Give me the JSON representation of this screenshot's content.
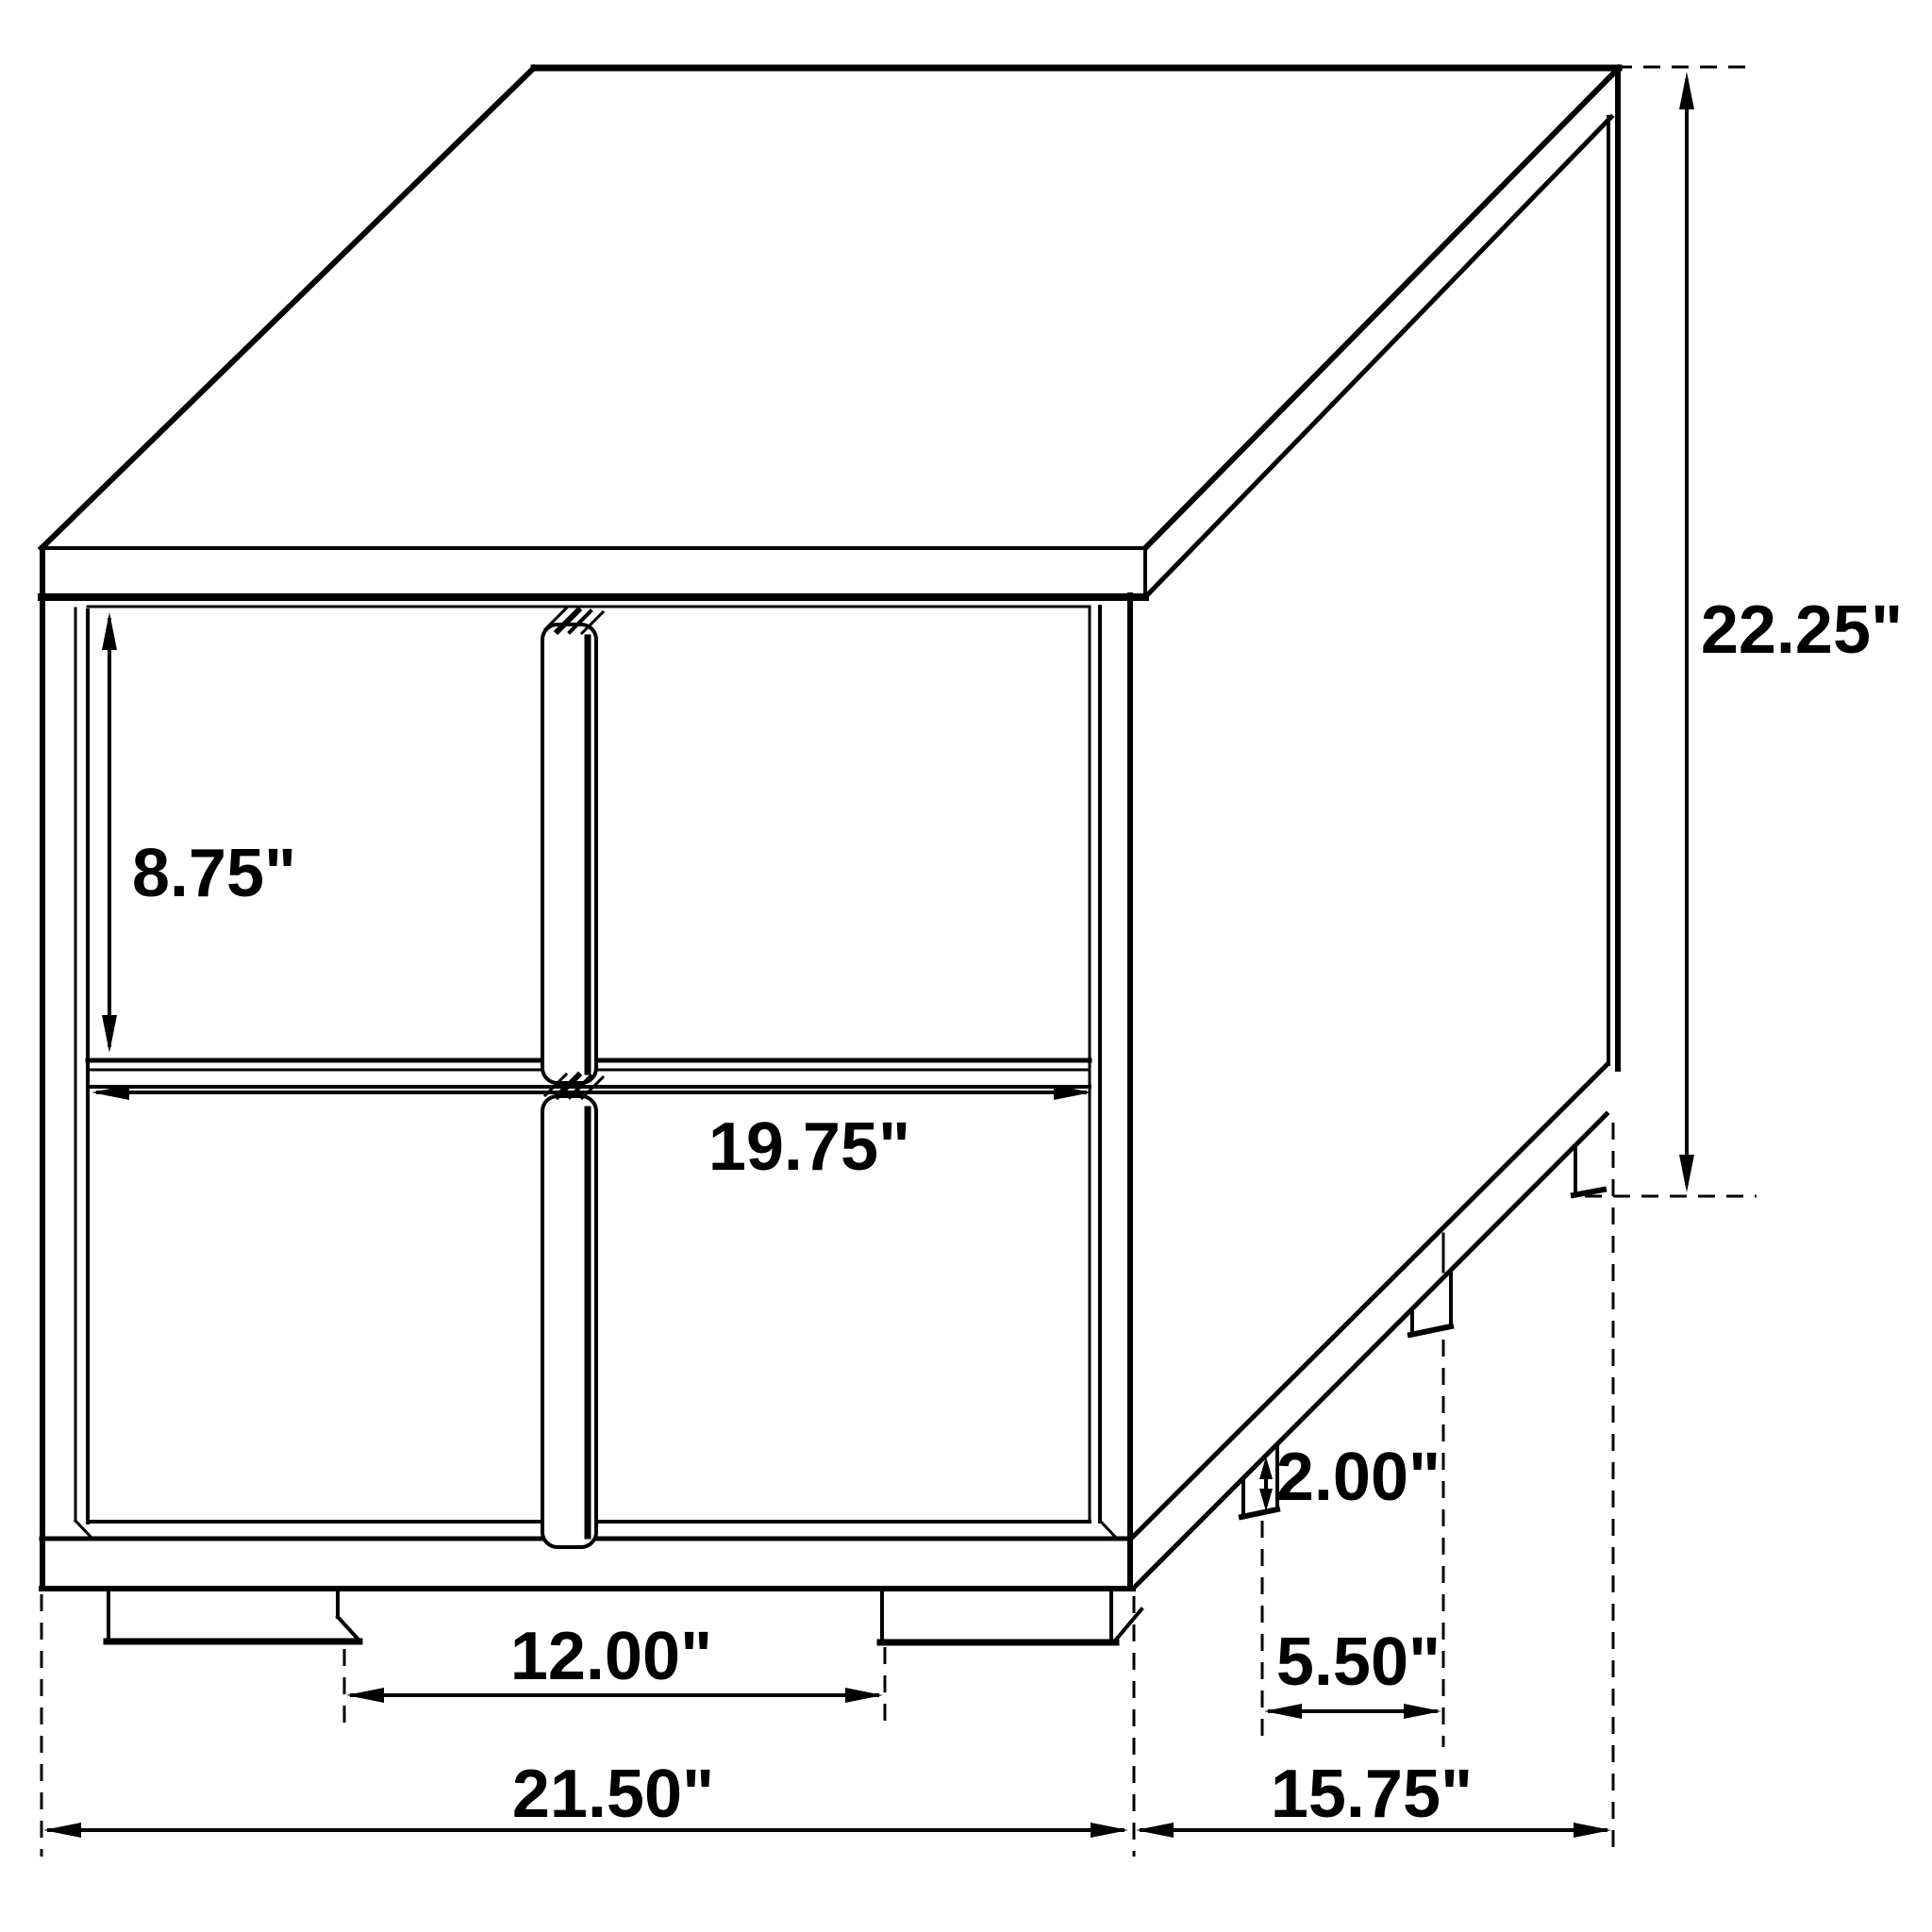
{
  "page": {
    "background": "#ffffff",
    "line_color": "#000000"
  },
  "diagram": {
    "kind": "isometric furniture dimension line drawing",
    "subject": "two-drawer nightstand with center pull handles and block feet",
    "units": "inches",
    "labels": {
      "drawer_opening_height": "8.75\"",
      "drawer_width": "19.75\"",
      "overall_height": "22.25\"",
      "foot_height": "2.00\"",
      "side_feet_gap": "5.50\"",
      "front_feet_gap": "12.00\"",
      "overall_width": "21.50\"",
      "overall_depth": "15.75\""
    }
  }
}
